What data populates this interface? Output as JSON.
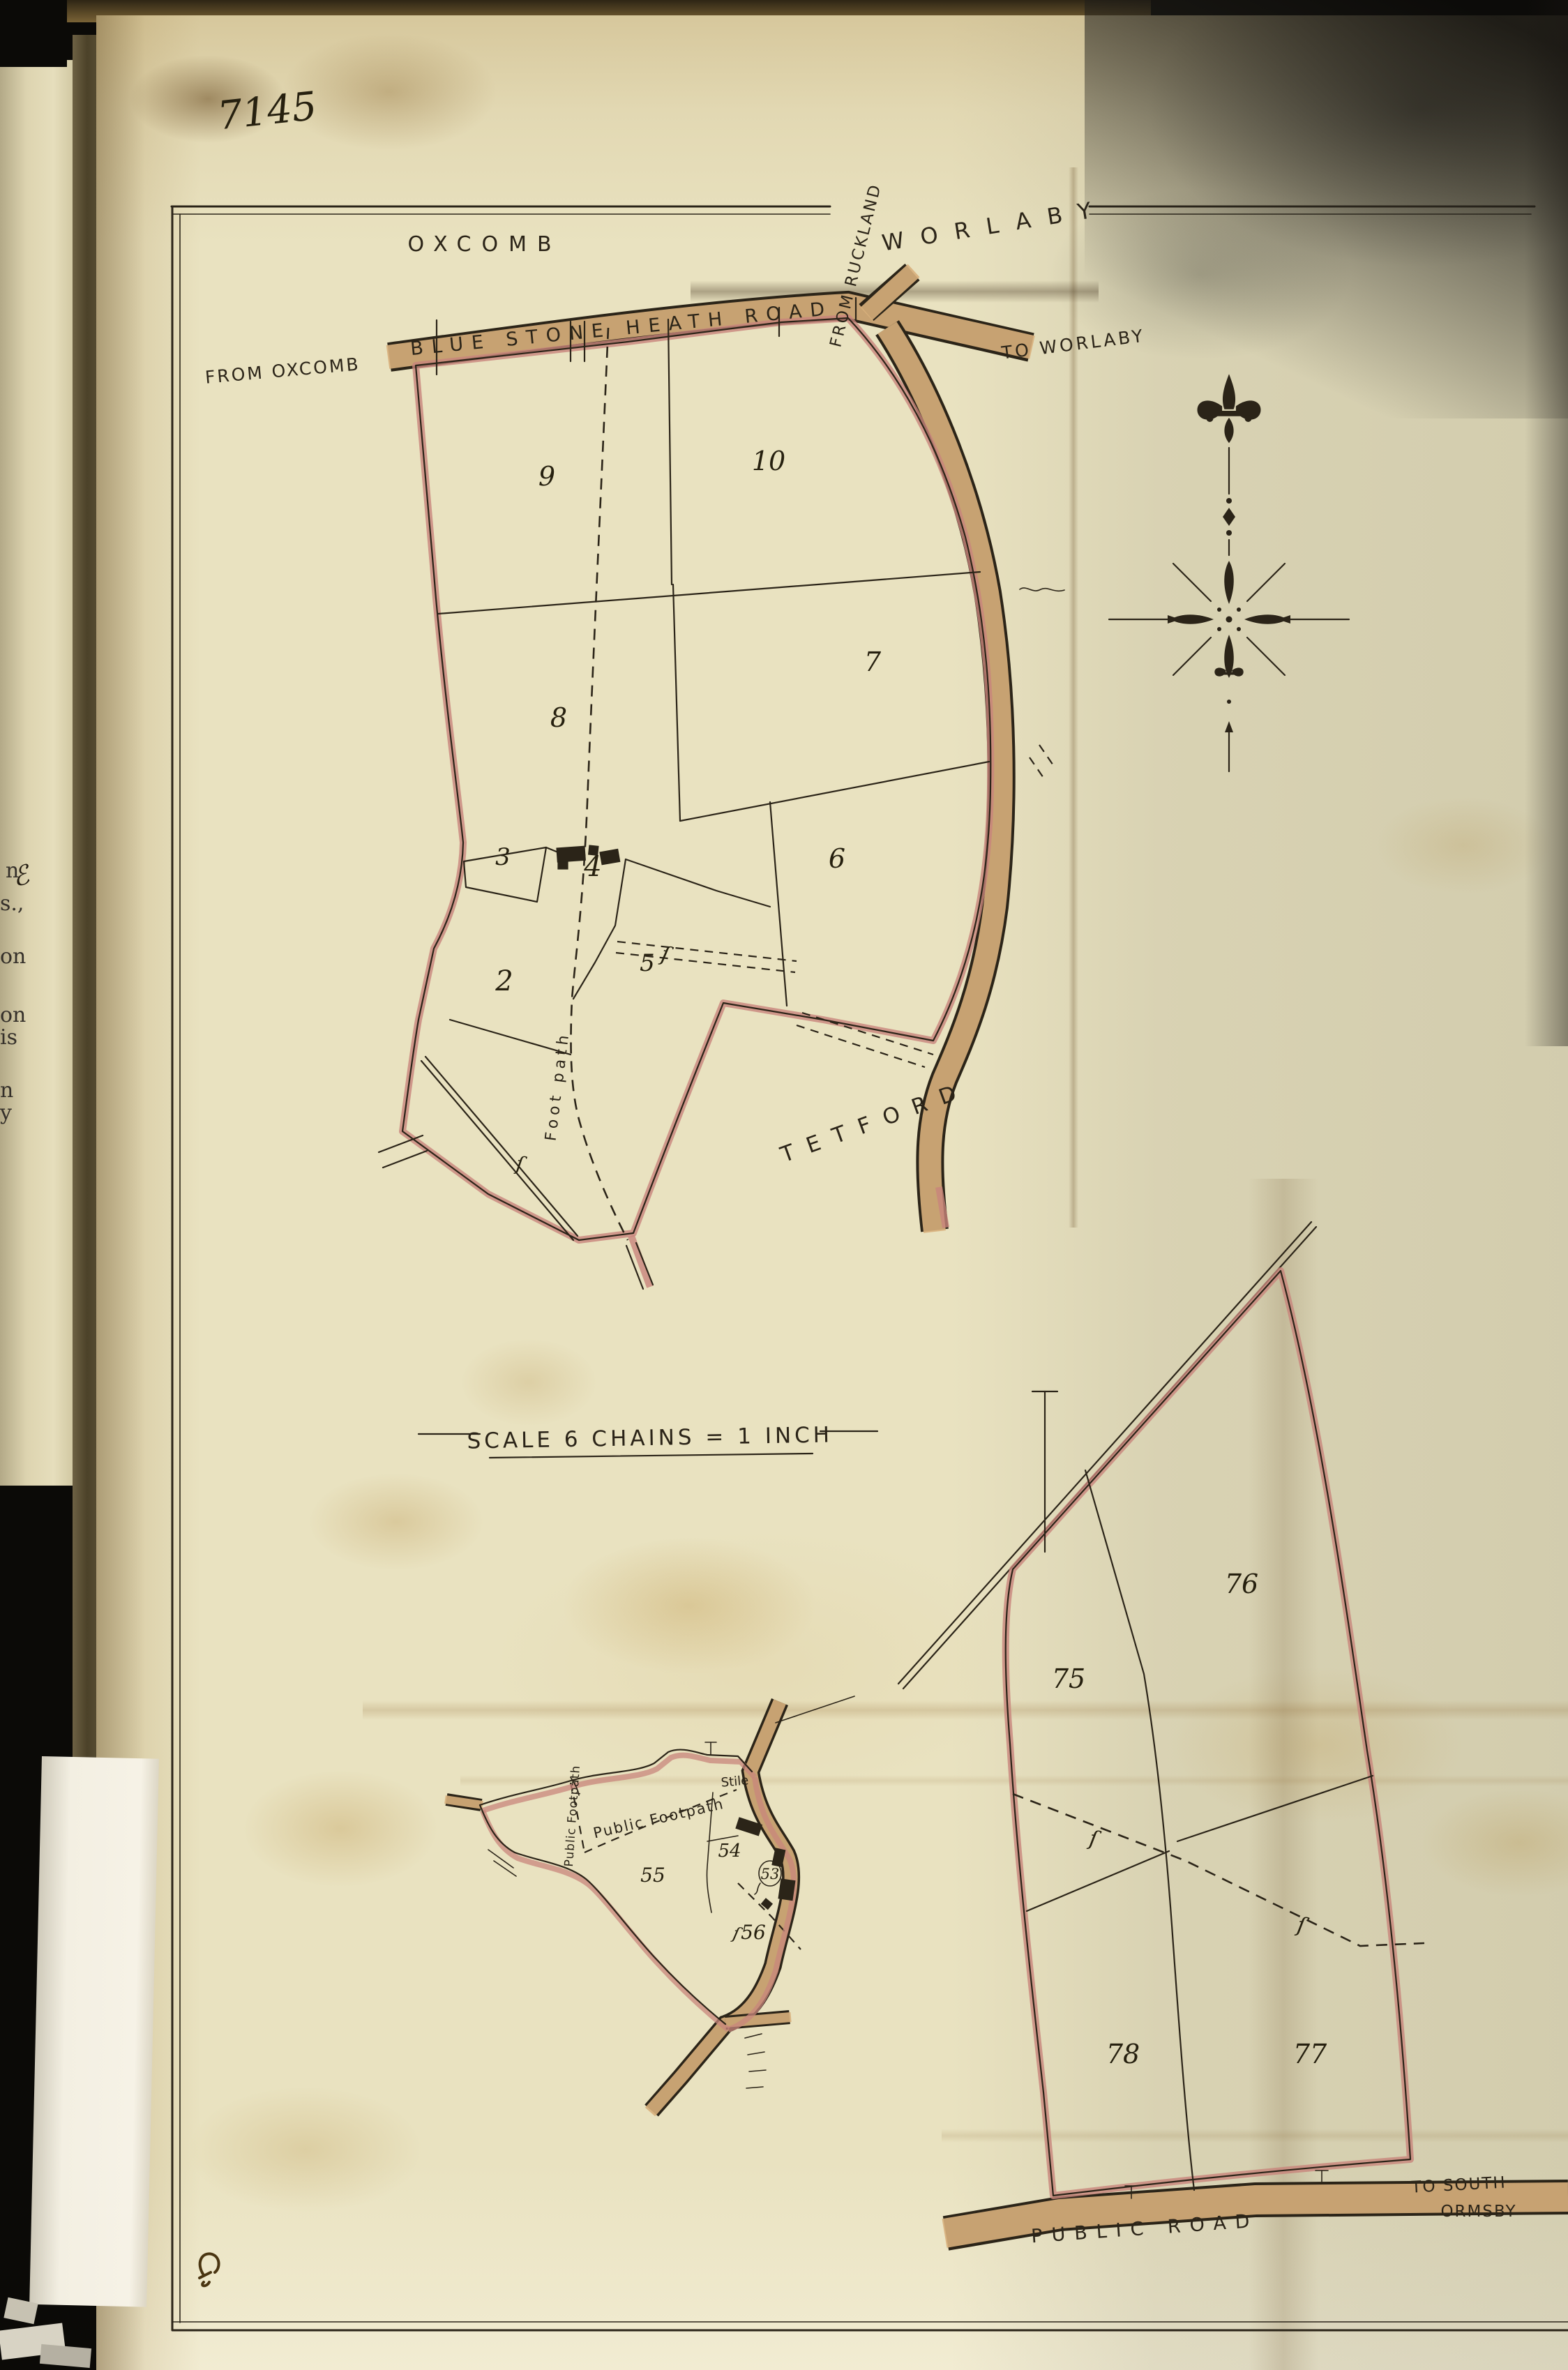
{
  "colors": {
    "ink": "#2b2418",
    "boundary_pink": "#c8857c",
    "road_tan": "#d8b07c",
    "paper": "#e9e2c0"
  },
  "annotations": {
    "plan_number": "7145",
    "scale_note": "SCALE 6 CHAINS = 1 INCH"
  },
  "labels": {
    "oxcomb": "OXCOMB",
    "worlaby": "WORLABY",
    "to_worlaby": "TO WORLABY",
    "from_ruckland": "FROM RUCKLAND",
    "from_oxcomb": "FROM OXCOMB",
    "blue_stone_heath_road": "BLUE STONE HEATH ROAD",
    "tetford": "TETFORD",
    "foot_path": "Foot path",
    "public_road": "PUBLIC ROAD",
    "to_south": "TO SOUTH",
    "ormsby": "ORMSBY",
    "public_footpath_diagonal": "Public Footpath",
    "public_footpath_vertical": "Public Footpath",
    "stile": "Stile",
    "squiggle": "ſ"
  },
  "parcels": {
    "n2": "2",
    "n3": "3",
    "n4": "4",
    "n5": "5",
    "n6": "6",
    "n7": "7",
    "n8": "8",
    "n9": "9",
    "n10": "10",
    "n53": "53",
    "n54": "54",
    "n55": "55",
    "n56": "56",
    "n75": "75",
    "n76": "76",
    "n77": "77",
    "n78": "78"
  },
  "book_edge": {
    "fragments": [
      "ℰ",
      "n",
      "s.,",
      "on",
      "on",
      "is",
      "n",
      "y"
    ]
  }
}
